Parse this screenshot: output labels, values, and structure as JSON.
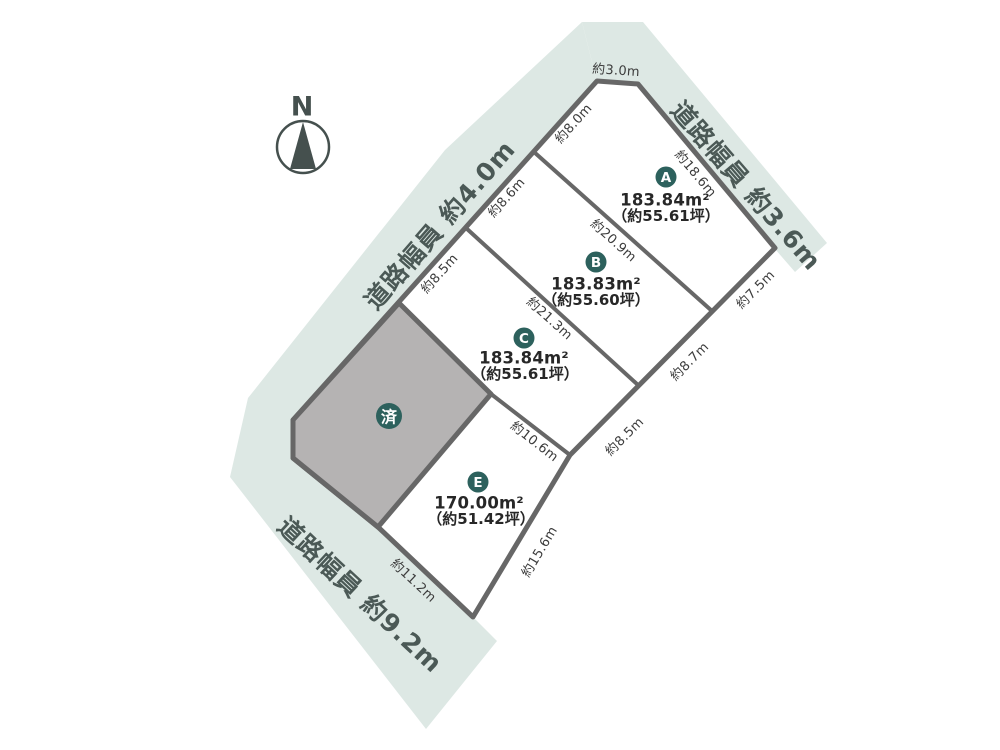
{
  "compass": {
    "north_label": "N"
  },
  "roads": {
    "northeast": {
      "label": "道路幅員 約3.6m"
    },
    "west": {
      "label": "道路幅員 約4.0m"
    },
    "south": {
      "label": "道路幅員 約9.2m"
    }
  },
  "lots": {
    "a": {
      "badge": "A",
      "area": "183.84m²",
      "tsubo": "（約55.61坪）"
    },
    "b": {
      "badge": "B",
      "area": "183.83m²",
      "tsubo": "（約55.60坪）"
    },
    "c": {
      "badge": "C",
      "area": "183.84m²",
      "tsubo": "（約55.61坪）"
    },
    "e": {
      "badge": "E",
      "area": "170.00m²",
      "tsubo": "（約51.42坪）"
    },
    "sold": {
      "badge": "済"
    }
  },
  "dimensions": {
    "top_chamfer": "約3.0m",
    "left_a": "約8.0m",
    "left_b": "約8.6m",
    "left_c": "約8.5m",
    "a_road_edge": "約18.6m",
    "divider_ab": "約20.9m",
    "divider_bc": "約21.3m",
    "divider_ce": "約10.6m",
    "right_a": "約7.5m",
    "right_b": "約8.7m",
    "right_c": "約8.5m",
    "e_southeast": "約15.6m",
    "e_south": "約11.2m"
  },
  "colors": {
    "road_fill": "#dde8e4",
    "plot_fill": "#ffffff",
    "sold_fill": "#b5b3b3",
    "boundary_stroke": "#676767",
    "badge_fill": "#2d615d",
    "dimension_text": "#3c3c3c",
    "road_text": "#4b5956"
  }
}
